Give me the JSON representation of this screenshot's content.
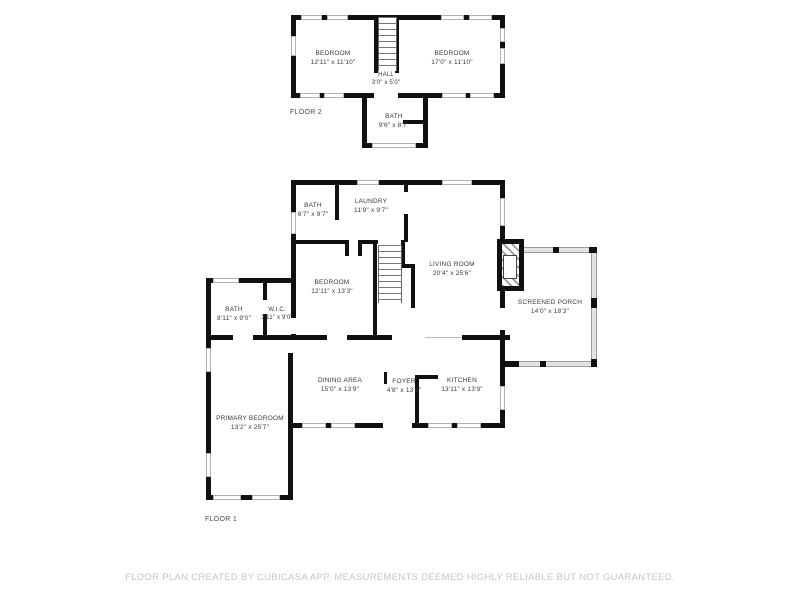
{
  "plan": {
    "floor2": {
      "label": "FLOOR 2",
      "rooms": {
        "bedroom_left": {
          "name": "BEDROOM",
          "dims": "12'11\" x 11'10\""
        },
        "bedroom_right": {
          "name": "BEDROOM",
          "dims": "17'0\" x 11'10\""
        },
        "hall": {
          "name": "HALL",
          "dims": "3'0\" x 5'0\""
        },
        "bath": {
          "name": "BATH",
          "dims": "9'6\" x 8'7\""
        }
      }
    },
    "floor1": {
      "label": "FLOOR 1",
      "rooms": {
        "bath_upper": {
          "name": "BATH",
          "dims": "6'7\" x 9'7\""
        },
        "laundry": {
          "name": "LAUNDRY",
          "dims": "11'9\" x 9'7\""
        },
        "bedroom": {
          "name": "BEDROOM",
          "dims": "12'11\" x 13'3\""
        },
        "living_room": {
          "name": "LIVING ROOM",
          "dims": "20'4\" x 25'6\""
        },
        "screened_porch": {
          "name": "SCREENED PORCH",
          "dims": "14'0\" x 18'3\""
        },
        "bath_primary": {
          "name": "BATH",
          "dims": "8'11\" x 9'0\""
        },
        "wic": {
          "name": "W.I.C.",
          "dims": "3'11\" x 9'0\""
        },
        "primary_bedroom": {
          "name": "PRIMARY BEDROOM",
          "dims": "13'2\" x 25'7\""
        },
        "dining_area": {
          "name": "DINING AREA",
          "dims": "15'0\" x 13'9\""
        },
        "foyer": {
          "name": "FOYER",
          "dims": "4'8\" x 13'9\""
        },
        "kitchen": {
          "name": "KITCHEN",
          "dims": "13'11\" x 13'9\""
        }
      }
    },
    "footer": {
      "disclaimer": "FLOOR PLAN CREATED BY CUBICASA APP. MEASUREMENTS DEEMED HIGHLY RELIABLE BUT NOT GUARANTEED."
    },
    "colors": {
      "wall": "#111111",
      "label_text": "#3a3a3a",
      "footer_text": "#c6c6c6",
      "window_frame": "#b3b3b3"
    }
  }
}
